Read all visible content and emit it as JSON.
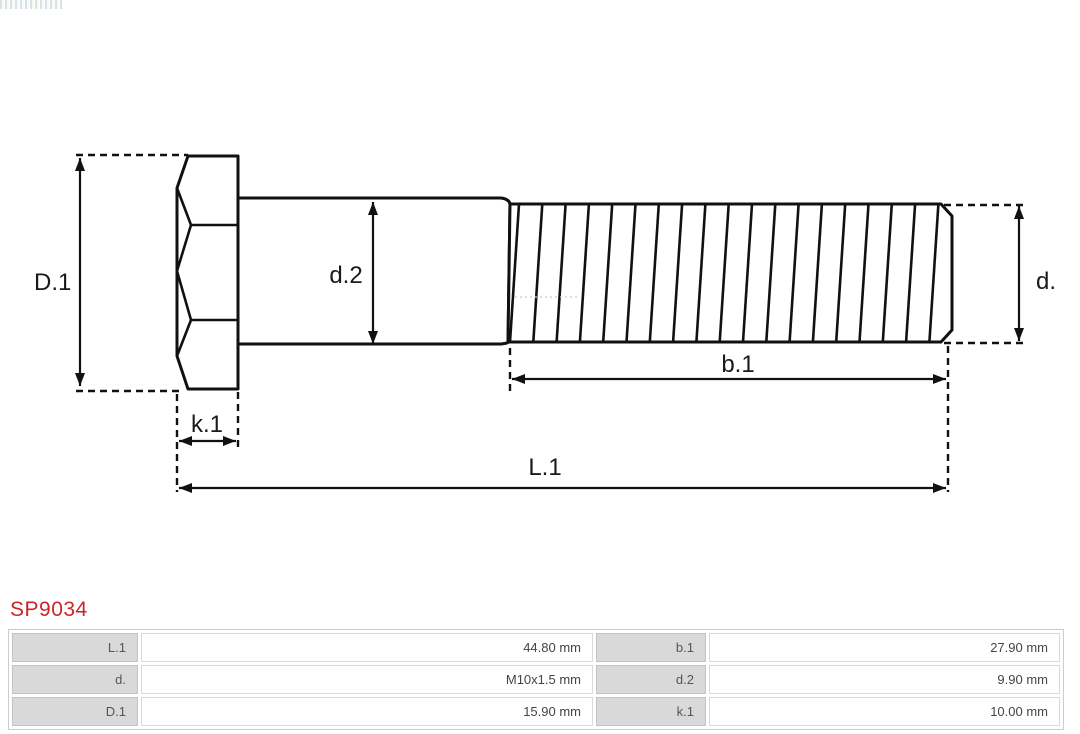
{
  "part_number": "SP9034",
  "colors": {
    "part_number_red": "#cc2529",
    "drawing_line": "#111111",
    "table_label_bg": "#d9d9d9",
    "table_border": "#cccccc"
  },
  "diagram": {
    "type": "technical-drawing-hex-bolt",
    "labels": {
      "D1": "D.1",
      "d2": "d.2",
      "d": "d.",
      "b1": "b.1",
      "k1": "k.1",
      "L1": "L.1"
    }
  },
  "table": {
    "rows": [
      {
        "label1": "L.1",
        "value1": "44.80 mm",
        "label2": "b.1",
        "value2": "27.90 mm"
      },
      {
        "label1": "d.",
        "value1": "M10x1.5 mm",
        "label2": "d.2",
        "value2": "9.90 mm"
      },
      {
        "label1": "D.1",
        "value1": "15.90 mm",
        "label2": "k.1",
        "value2": "10.00 mm"
      }
    ]
  }
}
